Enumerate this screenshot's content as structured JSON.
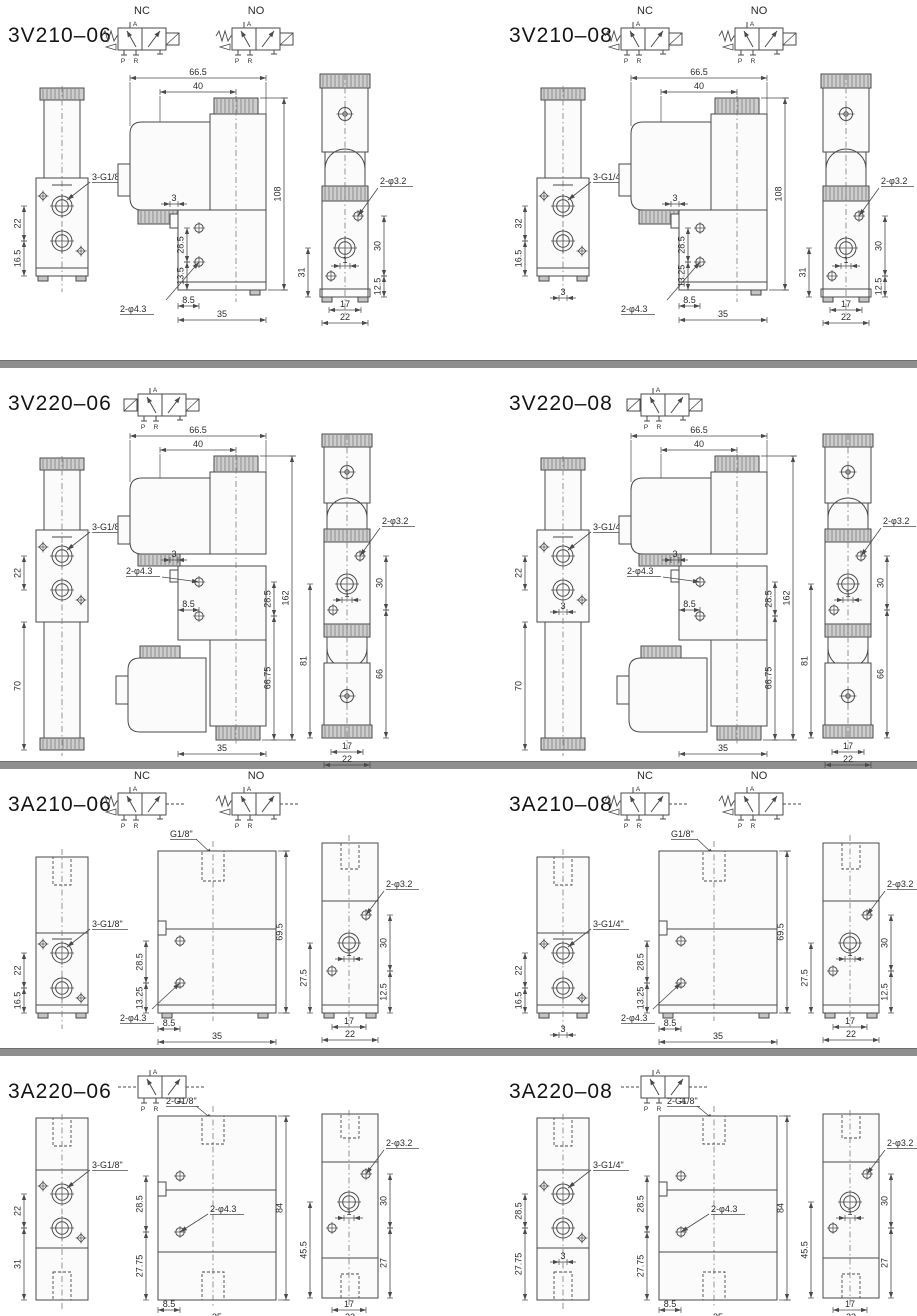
{
  "page": {
    "background": "#ffffff",
    "divider_color": "#8f8f8f",
    "line_color": "#4a4a4a",
    "knurl_fill": "#cdcdcd",
    "body_fill": "#fbfbfb",
    "text_color": "#2b2b2b"
  },
  "sections": [
    {
      "title": "3V210–06",
      "type": "V210",
      "symbol": {
        "kind": "single-solenoid-pair",
        "labels": [
          "NC",
          "NO"
        ],
        "ports": {
          "a": "A",
          "p": "P",
          "r": "R"
        }
      },
      "dims": {
        "thread": "3-G1/8\"",
        "v1_a": "22",
        "v1_b": "16.5",
        "v2_w1": "66.5",
        "v2_w2": "40",
        "v2_h": "108",
        "v2_step": "3",
        "v2_a": "28.5",
        "v2_b": "13.5",
        "v2_off": "8.5",
        "v2_base": "35",
        "v2_hole": "2-φ4.3",
        "v3_hole": "2-φ3.2",
        "v3_a": "30",
        "v3_b": "12.5",
        "v3_l": "31",
        "v3_c": "1",
        "v3_w1": "17",
        "v3_w2": "22"
      }
    },
    {
      "title": "3V210–08",
      "type": "V210",
      "symbol": {
        "kind": "single-solenoid-pair",
        "labels": [
          "NC",
          "NO"
        ],
        "ports": {
          "a": "A",
          "p": "P",
          "r": "R"
        }
      },
      "dims": {
        "thread": "3-G1/4\"",
        "v1_a": "32",
        "v1_b": "16.5",
        "v1_c": "3",
        "v2_w1": "66.5",
        "v2_w2": "40",
        "v2_h": "108",
        "v2_step": "3",
        "v2_a": "28.5",
        "v2_b": "13.25",
        "v2_off": "8.5",
        "v2_base": "35",
        "v2_hole": "2-φ4.3",
        "v3_hole": "2-φ3.2",
        "v3_a": "30",
        "v3_b": "12.5",
        "v3_l": "31",
        "v3_c": "1",
        "v3_w1": "17",
        "v3_w2": "22"
      }
    },
    {
      "title": "3V220–06",
      "type": "V220",
      "symbol": {
        "kind": "double-solenoid",
        "labels": [],
        "ports": {
          "a": "A",
          "p": "P",
          "r": "R"
        }
      },
      "dims": {
        "thread": "3-G1/8\"",
        "v1_a": "22",
        "v1_b": "70",
        "v2_w1": "66.5",
        "v2_w2": "40",
        "v2_h": "162",
        "v2_step": "3",
        "v2_a": "28.5",
        "v2_b": "66.75",
        "v2_off": "8.5",
        "v2_base": "35",
        "v2_hole": "2-φ4.3",
        "v3_hole": "2-φ3.2",
        "v3_a": "30",
        "v3_b": "66",
        "v3_l": "81",
        "v3_c": "1",
        "v3_w1": "17",
        "v3_w2": "22"
      }
    },
    {
      "title": "3V220–08",
      "type": "V220",
      "symbol": {
        "kind": "double-solenoid",
        "labels": [],
        "ports": {
          "a": "A",
          "p": "P",
          "r": "R"
        }
      },
      "dims": {
        "thread": "3-G1/4\"",
        "v1_a": "22",
        "v1_b": "70",
        "v1_c": "3",
        "v2_w1": "66.5",
        "v2_w2": "40",
        "v2_h": "162",
        "v2_step": "3",
        "v2_a": "28.5",
        "v2_b": "66.75",
        "v2_off": "8.5",
        "v2_base": "35",
        "v2_hole": "2-φ4.3",
        "v3_hole": "2-φ3.2",
        "v3_a": "30",
        "v3_b": "66",
        "v3_l": "81",
        "v3_c": "1",
        "v3_w1": "17",
        "v3_w2": "22"
      }
    },
    {
      "title": "3A210–06",
      "type": "A210",
      "symbol": {
        "kind": "single-air-pilot-pair",
        "labels": [
          "NC",
          "NO"
        ],
        "ports": {
          "a": "A",
          "p": "P",
          "r": "R"
        }
      },
      "dims": {
        "top_thread": "G1/8\"",
        "thread": "3-G1/8\"",
        "v1_a": "22",
        "v1_b": "16.5",
        "v2_h": "69.5",
        "v2_a": "28.5",
        "v2_b": "13.25",
        "v2_off": "8.5",
        "v2_base": "35",
        "v2_hole": "2-φ4.3",
        "v3_hole": "2-φ3.2",
        "v3_a": "30",
        "v3_b": "12.5",
        "v3_l": "27.5",
        "v3_c": "1",
        "v3_w1": "17",
        "v3_w2": "22"
      }
    },
    {
      "title": "3A210–08",
      "type": "A210",
      "symbol": {
        "kind": "single-air-pilot-pair",
        "labels": [
          "NC",
          "NO"
        ],
        "ports": {
          "a": "A",
          "p": "P",
          "r": "R"
        }
      },
      "dims": {
        "top_thread": "G1/8\"",
        "thread": "3-G1/4\"",
        "v1_a": "22",
        "v1_b": "16.5",
        "v1_c": "3",
        "v2_h": "69.5",
        "v2_a": "28.5",
        "v2_b": "13.25",
        "v2_off": "8.5",
        "v2_base": "35",
        "v2_hole": "2-φ4.3",
        "v3_hole": "2-φ3.2",
        "v3_a": "30",
        "v3_b": "12.5",
        "v3_l": "27.5",
        "v3_c": "1",
        "v3_w1": "17",
        "v3_w2": "22"
      }
    },
    {
      "title": "3A220–06",
      "type": "A220",
      "symbol": {
        "kind": "double-air-pilot",
        "labels": [],
        "ports": {
          "a": "A",
          "p": "P",
          "r": "R"
        }
      },
      "dims": {
        "top_thread": "2-G1/8\"",
        "thread": "3-G1/8\"",
        "v1_a": "22",
        "v1_b": "31",
        "v2_h": "84",
        "v2_a": "28.5",
        "v2_b": "27.75",
        "v2_off": "8.5",
        "v2_base": "35",
        "v2_hole": "2-φ4.3",
        "v3_hole": "2-φ3.2",
        "v3_a": "30",
        "v3_b": "27",
        "v3_l": "45.5",
        "v3_c": "1",
        "v3_w1": "17",
        "v3_w2": "22"
      }
    },
    {
      "title": "3A220–08",
      "type": "A220",
      "symbol": {
        "kind": "double-air-pilot",
        "labels": [],
        "ports": {
          "a": "A",
          "p": "P",
          "r": "R"
        }
      },
      "dims": {
        "top_thread": "2-G1/8\"",
        "thread": "3-G1/4\"",
        "v1_a": "28.5",
        "v1_b": "27.75",
        "v1_c": "3",
        "v2_h": "84",
        "v2_a": "28.5",
        "v2_b": "27.75",
        "v2_off": "8.5",
        "v2_base": "35",
        "v2_hole": "2-φ4.3",
        "v3_hole": "2-φ3.2",
        "v3_a": "30",
        "v3_b": "27",
        "v3_l": "45.5",
        "v3_c": "1",
        "v3_w1": "17",
        "v3_w2": "22"
      }
    }
  ]
}
